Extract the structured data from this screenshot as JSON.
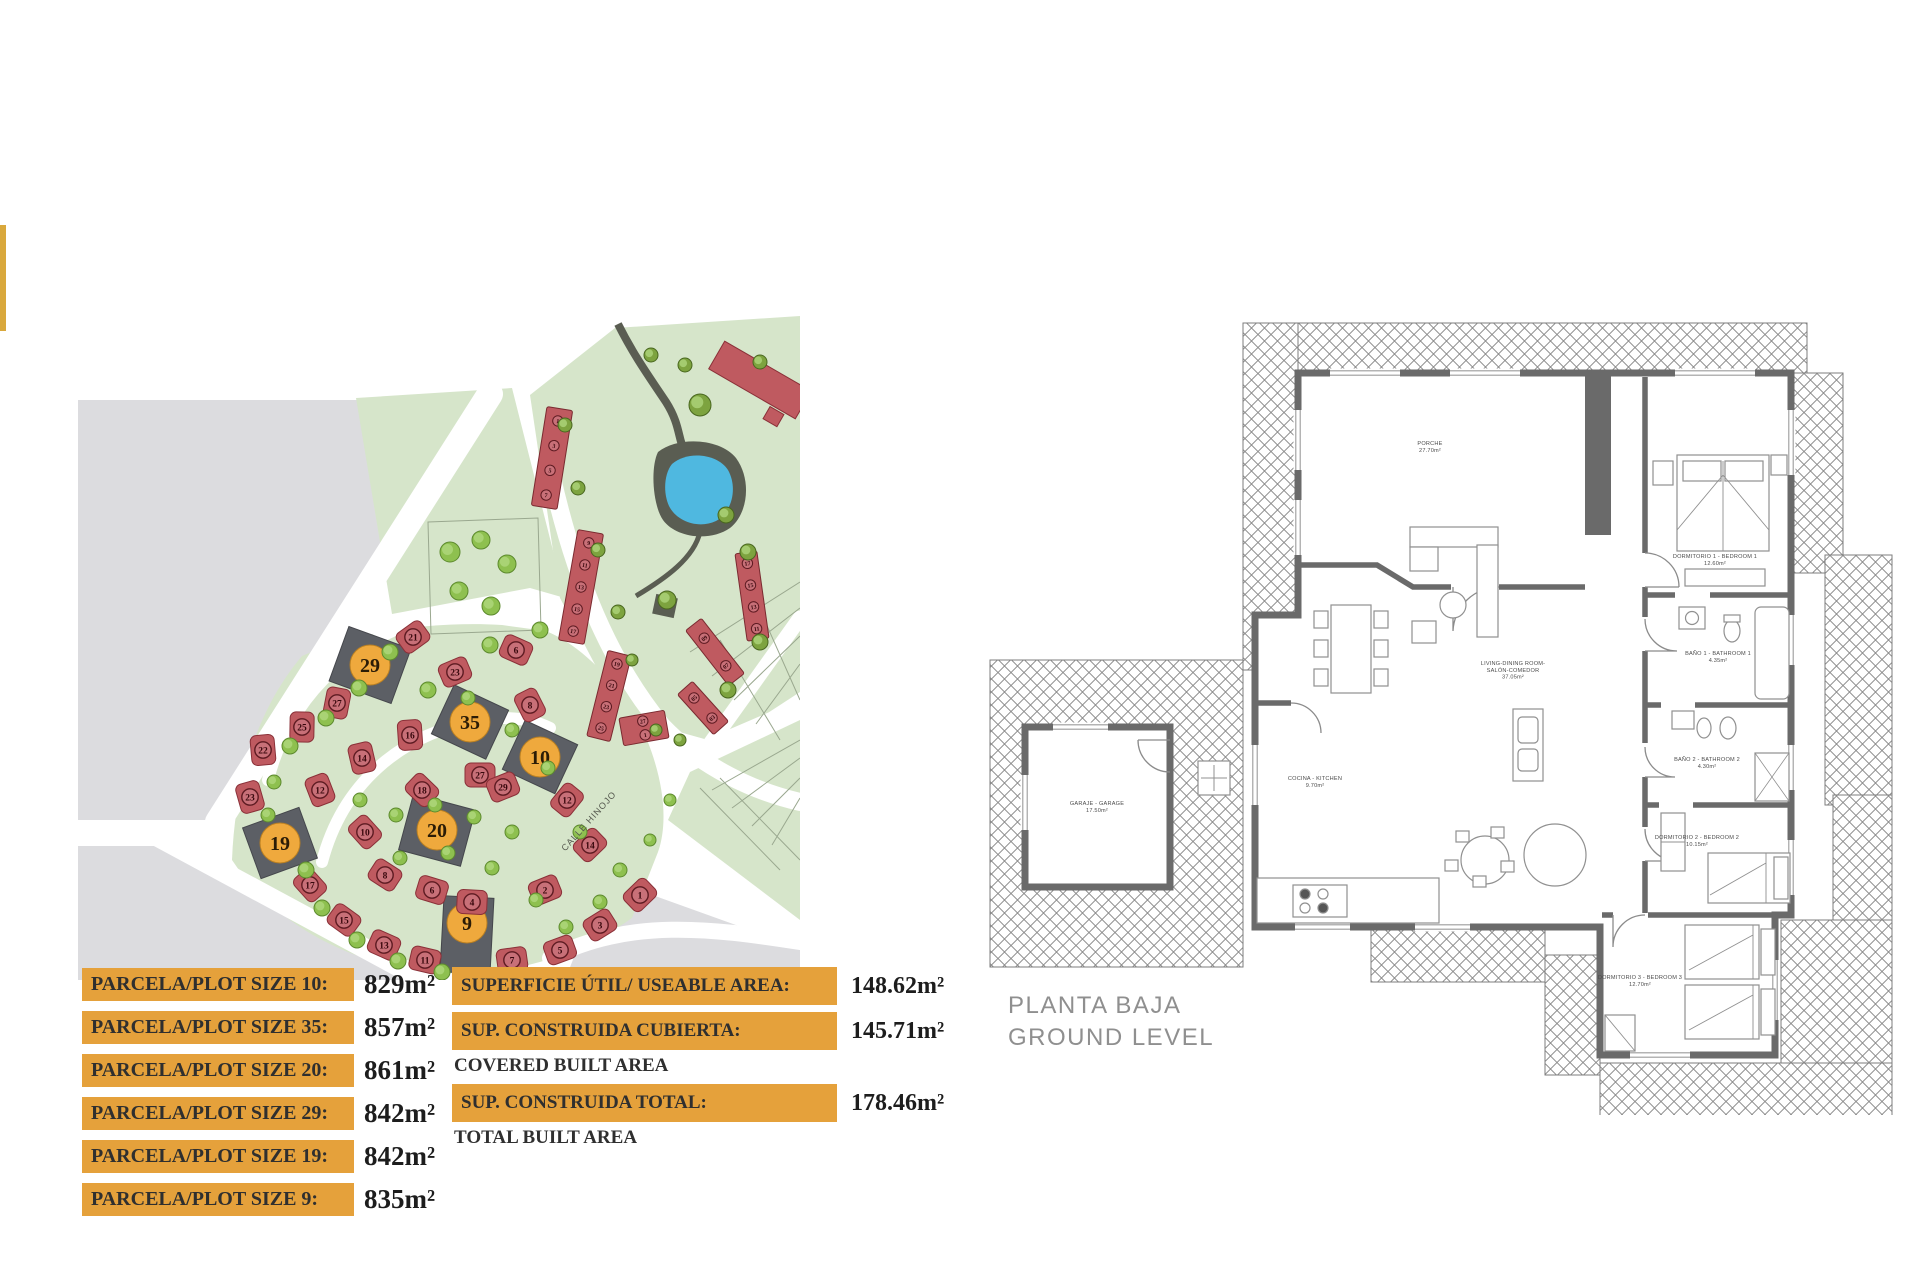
{
  "page": {
    "background": "#ffffff"
  },
  "accent_bar": {
    "color": "#D9A83C"
  },
  "site_plan": {
    "street_label": "CALLE HINOJO",
    "colors": {
      "land": "#d6e5ca",
      "outside": "#dcdcdf",
      "road": "#ffffff",
      "house": "#bf5a60",
      "house_inner": "#c87078",
      "house_ring": "#5e1b22",
      "highlight_plot": "#5c5f65",
      "highlight_circle": "#EFA93D",
      "tree": "#8ec04f",
      "tree_dark": "#7da33f",
      "pond": "#4FB8E0",
      "pond_bank": "#5a5d52"
    },
    "featured_plots": [
      {
        "n": "29",
        "x": 310,
        "y": 365,
        "rot": 20,
        "w": 66,
        "h": 58,
        "co": 0
      },
      {
        "n": "35",
        "x": 410,
        "y": 422,
        "rot": 25,
        "w": 60,
        "h": 54,
        "co": 0
      },
      {
        "n": "10",
        "x": 480,
        "y": 457,
        "rot": 25,
        "w": 58,
        "h": 54,
        "co": 0
      },
      {
        "n": "20",
        "x": 377,
        "y": 530,
        "rot": 15,
        "w": 64,
        "h": 58,
        "co": 0
      },
      {
        "n": "19",
        "x": 220,
        "y": 543,
        "rot": -20,
        "w": 60,
        "h": 54,
        "co": 0
      },
      {
        "n": "9",
        "x": 407,
        "y": 635,
        "rot": 3,
        "w": 50,
        "h": 76,
        "co": -12
      }
    ],
    "houses": [
      {
        "n": "21",
        "x": 353,
        "y": 337
      },
      {
        "n": "27",
        "x": 277,
        "y": 403
      },
      {
        "n": "25",
        "x": 242,
        "y": 427
      },
      {
        "n": "22",
        "x": 203,
        "y": 450
      },
      {
        "n": "23",
        "x": 190,
        "y": 497
      },
      {
        "n": "17",
        "x": 250,
        "y": 585
      },
      {
        "n": "15",
        "x": 284,
        "y": 620
      },
      {
        "n": "13",
        "x": 324,
        "y": 645
      },
      {
        "n": "11",
        "x": 365,
        "y": 660
      },
      {
        "n": "16",
        "x": 350,
        "y": 435
      },
      {
        "n": "14",
        "x": 302,
        "y": 458
      },
      {
        "n": "12",
        "x": 260,
        "y": 490
      },
      {
        "n": "10",
        "x": 305,
        "y": 532
      },
      {
        "n": "18",
        "x": 362,
        "y": 490
      },
      {
        "n": "8",
        "x": 325,
        "y": 575
      },
      {
        "n": "6",
        "x": 372,
        "y": 590
      },
      {
        "n": "4",
        "x": 412,
        "y": 602
      },
      {
        "n": "23",
        "x": 395,
        "y": 372
      },
      {
        "n": "27",
        "x": 420,
        "y": 475
      },
      {
        "n": "6",
        "x": 456,
        "y": 350
      },
      {
        "n": "8",
        "x": 470,
        "y": 405
      },
      {
        "n": "29",
        "x": 443,
        "y": 487
      },
      {
        "n": "12",
        "x": 507,
        "y": 500
      },
      {
        "n": "14",
        "x": 530,
        "y": 545
      },
      {
        "n": "2",
        "x": 485,
        "y": 590
      },
      {
        "n": "1",
        "x": 580,
        "y": 595
      },
      {
        "n": "3",
        "x": 540,
        "y": 625
      },
      {
        "n": "5",
        "x": 500,
        "y": 650
      },
      {
        "n": "7",
        "x": 452,
        "y": 660
      }
    ],
    "townhouse_strips": [
      {
        "x": 492,
        "y": 158,
        "w": 26,
        "h": 100,
        "rot": 9,
        "units": [
          "1",
          "3",
          "5",
          "7"
        ]
      },
      {
        "x": 521,
        "y": 287,
        "w": 26,
        "h": 112,
        "rot": 10,
        "units": [
          "9",
          "11",
          "13",
          "15",
          "17"
        ]
      },
      {
        "x": 549,
        "y": 396,
        "w": 24,
        "h": 88,
        "rot": 14,
        "units": [
          "19",
          "21",
          "23",
          "25"
        ]
      },
      {
        "x": 692,
        "y": 296,
        "w": 22,
        "h": 88,
        "rot": -8,
        "units": [
          "17",
          "15",
          "13",
          "11"
        ]
      },
      {
        "x": 655,
        "y": 352,
        "w": 20,
        "h": 70,
        "rot": -38,
        "units": [
          "09",
          "07"
        ]
      },
      {
        "x": 643,
        "y": 408,
        "w": 20,
        "h": 54,
        "rot": -42,
        "units": [
          "05",
          "03"
        ]
      },
      {
        "x": 584,
        "y": 428,
        "w": 46,
        "h": 28,
        "rot": -10,
        "units": [
          "27",
          "1"
        ]
      }
    ],
    "trees": [
      [
        330,
        352,
        8
      ],
      [
        299,
        388,
        8
      ],
      [
        266,
        418,
        8
      ],
      [
        230,
        446,
        8
      ],
      [
        214,
        482,
        7
      ],
      [
        208,
        515,
        7
      ],
      [
        246,
        570,
        8
      ],
      [
        262,
        608,
        8
      ],
      [
        297,
        640,
        8
      ],
      [
        338,
        661,
        8
      ],
      [
        382,
        672,
        8
      ],
      [
        300,
        500,
        7
      ],
      [
        336,
        515,
        7
      ],
      [
        375,
        505,
        7
      ],
      [
        340,
        558,
        7
      ],
      [
        388,
        553,
        7
      ],
      [
        432,
        568,
        7
      ],
      [
        414,
        517,
        7
      ],
      [
        452,
        532,
        7
      ],
      [
        476,
        600,
        7
      ],
      [
        506,
        627,
        7
      ],
      [
        540,
        602,
        7
      ],
      [
        452,
        430,
        7
      ],
      [
        488,
        468,
        7
      ],
      [
        430,
        345,
        8
      ],
      [
        368,
        390,
        8
      ],
      [
        408,
        398,
        7
      ],
      [
        480,
        330,
        8
      ],
      [
        520,
        532,
        7
      ],
      [
        560,
        570,
        7
      ],
      [
        590,
        540,
        6
      ],
      [
        610,
        500,
        6
      ],
      [
        390,
        252,
        10
      ],
      [
        421,
        240,
        9
      ],
      [
        447,
        264,
        9
      ],
      [
        399,
        291,
        9
      ],
      [
        431,
        306,
        9
      ]
    ],
    "trees_dark": [
      [
        505,
        125,
        7
      ],
      [
        518,
        188,
        7
      ],
      [
        538,
        250,
        7
      ],
      [
        558,
        312,
        7
      ],
      [
        572,
        360,
        6
      ],
      [
        640,
        105,
        11
      ],
      [
        666,
        215,
        8
      ],
      [
        688,
        252,
        8
      ],
      [
        700,
        342,
        8
      ],
      [
        668,
        390,
        8
      ],
      [
        607,
        300,
        9
      ],
      [
        591,
        55,
        7
      ],
      [
        625,
        65,
        7
      ],
      [
        700,
        62,
        7
      ],
      [
        596,
        430,
        6
      ],
      [
        620,
        440,
        6
      ]
    ]
  },
  "legend": {
    "bar_color": "#E5A13B",
    "parcels": [
      {
        "label": "PARCELA/PLOT SIZE 10:",
        "value": "829m²"
      },
      {
        "label": "PARCELA/PLOT SIZE 35:",
        "value": "857m²"
      },
      {
        "label": "PARCELA/PLOT SIZE 20:",
        "value": "861m²"
      },
      {
        "label": "PARCELA/PLOT SIZE 29:",
        "value": "842m²"
      },
      {
        "label": "PARCELA/PLOT SIZE 19:",
        "value": "842m²"
      },
      {
        "label": "PARCELA/PLOT SIZE 9:",
        "value": "835m²"
      }
    ],
    "areas": [
      {
        "label": "SUPERFICIE ÚTIL/ USEABLE AREA:",
        "sub": "",
        "value": "148.62m²"
      },
      {
        "label": "SUP. CONSTRUIDA CUBIERTA:",
        "sub": "COVERED BUILT AREA",
        "value": "145.71m²"
      },
      {
        "label": "SUP. CONSTRUIDA TOTAL:",
        "sub": "TOTAL BUILT AREA",
        "value": "178.46m²"
      }
    ]
  },
  "floor_plan": {
    "title_line1": "PLANTA BAJA",
    "title_line2": "GROUND LEVEL",
    "rooms": [
      {
        "x": 445,
        "y": 130,
        "lines": [
          "PORCHE",
          "27.70m²"
        ]
      },
      {
        "x": 528,
        "y": 350,
        "lines": [
          "LIVING-DINING ROOM-",
          "SALÓN-COMEDOR",
          "37.05m²"
        ]
      },
      {
        "x": 330,
        "y": 465,
        "lines": [
          "COCINA - KITCHEN",
          "9.70m²"
        ]
      },
      {
        "x": 112,
        "y": 490,
        "lines": [
          "GARAJE - GARAGE",
          "17.50m²"
        ]
      },
      {
        "x": 730,
        "y": 243,
        "lines": [
          "DORMITORIO 1 - BEDROOM 1",
          "12.60m²"
        ]
      },
      {
        "x": 733,
        "y": 340,
        "lines": [
          "BAÑO 1 - BATHROOM 1",
          "4.35m²"
        ]
      },
      {
        "x": 722,
        "y": 446,
        "lines": [
          "BAÑO 2 - BATHROOM 2",
          "4.30m²"
        ]
      },
      {
        "x": 712,
        "y": 524,
        "lines": [
          "DORMITORIO 2 - BEDROOM 2",
          "10.15m²"
        ]
      },
      {
        "x": 655,
        "y": 664,
        "lines": [
          "DORMITORIO 3 - BEDROOM 3",
          "12.70m²"
        ]
      }
    ]
  }
}
